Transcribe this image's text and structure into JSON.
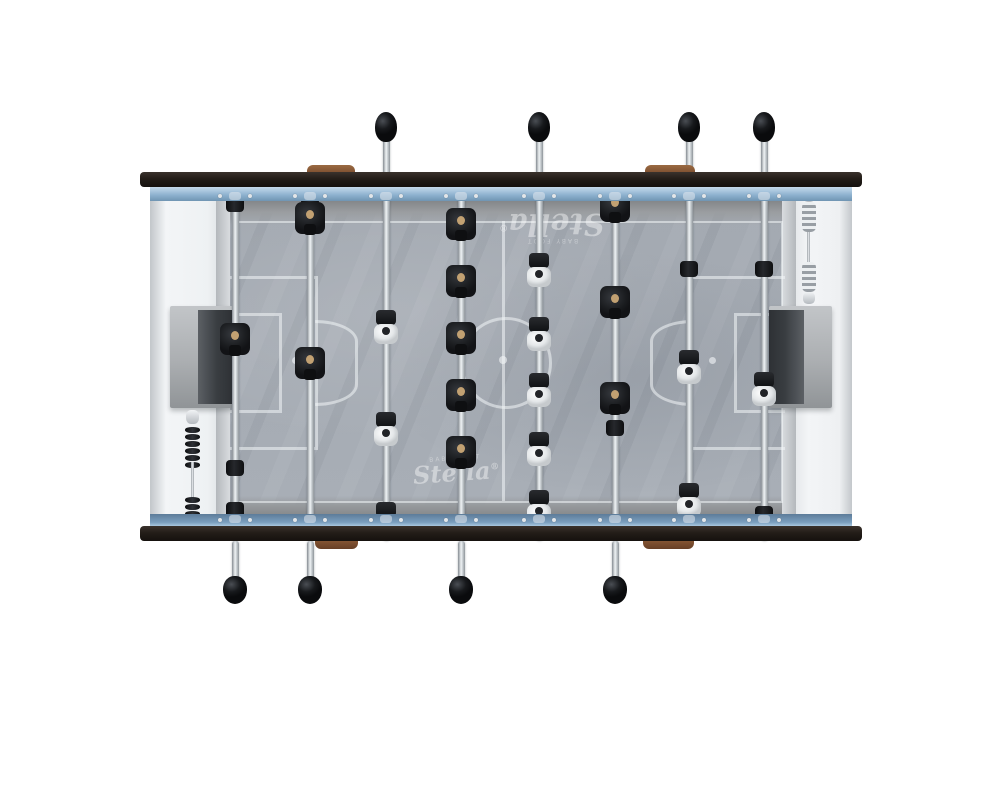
{
  "image": {
    "subject": "top view of a Stella baby-foot (foosball) table, product render",
    "background_color": "#ffffff"
  },
  "branding": {
    "logo_text": "Stella",
    "logo_mark": "®",
    "logo_subtext": "BABY FOOT",
    "logo_color": "rgba(255,255,255,0.42)",
    "placements": [
      {
        "id": "field-logo-top",
        "x": 552,
        "y": 232,
        "rotation": 180,
        "size": 30
      },
      {
        "id": "field-logo-bottom",
        "x": 456,
        "y": 477,
        "rotation": -4,
        "size": 24
      }
    ]
  },
  "palette": {
    "frame_rail": "#231d18",
    "wall_blue_top": "#8fb3d0",
    "wall_blue_bottom": "#7b9fbf",
    "cabinet_white": "#eef1f3",
    "field_gray": "#a6acb4",
    "pitch_line": "rgba(243,246,248,0.55)",
    "rod_silver": "#c3c9cd",
    "knob_black": "#121417",
    "wood_accent": "#7c4e2f",
    "team_black": "#1d1f23",
    "team_white": "#edeff1",
    "goal_gray": "#abaeb1"
  },
  "table": {
    "frame": {
      "x": 140,
      "y": 172,
      "width": 722,
      "rail_height": 15,
      "bottom_rail_y": 526
    },
    "field": {
      "x": 230,
      "y": 201,
      "width": 552,
      "height": 313
    },
    "teams": [
      {
        "id": "black-team",
        "color": "black",
        "handle_side": "bottom"
      },
      {
        "id": "white-team",
        "color": "white",
        "handle_side": "top"
      }
    ],
    "rods": [
      {
        "x": 235,
        "team": 0,
        "role": "goalkeeper",
        "players": [
          339
        ],
        "bumpers": [
          204,
          468,
          510
        ]
      },
      {
        "x": 310,
        "team": 0,
        "role": "defense",
        "players": [
          218,
          363
        ],
        "bumpers": [
          197
        ]
      },
      {
        "x": 386,
        "team": 1,
        "role": "attack",
        "players": [
          328,
          430,
          520
        ],
        "bumpers": []
      },
      {
        "x": 461,
        "team": 0,
        "role": "midfield",
        "players": [
          224,
          281,
          338,
          395,
          452
        ],
        "bumpers": [
          527
        ]
      },
      {
        "x": 539,
        "team": 1,
        "role": "midfield",
        "players": [
          271,
          335,
          391,
          450,
          508
        ],
        "bumpers": []
      },
      {
        "x": 615,
        "team": 0,
        "role": "attack",
        "players": [
          206,
          302,
          398
        ],
        "bumpers": [
          428
        ]
      },
      {
        "x": 689,
        "team": 1,
        "role": "defense",
        "players": [
          368,
          501
        ],
        "bumpers": [
          269
        ]
      },
      {
        "x": 764,
        "team": 1,
        "role": "goalkeeper",
        "players": [
          390
        ],
        "bumpers": [
          269,
          514
        ]
      }
    ],
    "handles": {
      "top_knob_y": 112,
      "top_shaft": [
        138,
        176
      ],
      "bottom_shaft": [
        541,
        579
      ],
      "bottom_knob_y": 576
    },
    "goals": [
      {
        "side": "left",
        "box": [
          170,
          306,
          63,
          102
        ],
        "opening": [
          198,
          310,
          35,
          94
        ]
      },
      {
        "side": "right",
        "box": [
          769,
          306,
          63,
          102
        ],
        "opening": [
          769,
          310,
          35,
          94
        ]
      }
    ],
    "score_counters": [
      {
        "side": "left",
        "x": 186,
        "y": 410,
        "style": "black-beads"
      },
      {
        "side": "right",
        "x": 803,
        "y": 190,
        "style": "silver-springs"
      }
    ],
    "wood_tabs": {
      "top": [
        {
          "x": 307,
          "w": 48
        },
        {
          "x": 645,
          "w": 50
        }
      ],
      "bottom": [
        {
          "x": 315,
          "w": 43
        },
        {
          "x": 643,
          "w": 51
        }
      ]
    },
    "markings": {
      "boundary": [
        233,
        221,
        546,
        278
      ],
      "center_line_x": 503,
      "center_circle": {
        "cx": 503,
        "cy": 360,
        "r": 43
      },
      "center_spot_r": 4,
      "left_big_box": [
        230,
        276,
        85,
        168
      ],
      "left_small_box": [
        230,
        313,
        49,
        94
      ],
      "left_arc": {
        "cx": 315,
        "cy": 360,
        "r": 40
      },
      "left_spot": [
        295,
        360
      ],
      "right_big_box": [
        690,
        276,
        92,
        168
      ],
      "right_small_box": [
        734,
        313,
        48,
        94
      ],
      "right_arc": {
        "cx": 690,
        "cy": 360,
        "r": 40
      },
      "right_spot": [
        712,
        360
      ]
    }
  }
}
